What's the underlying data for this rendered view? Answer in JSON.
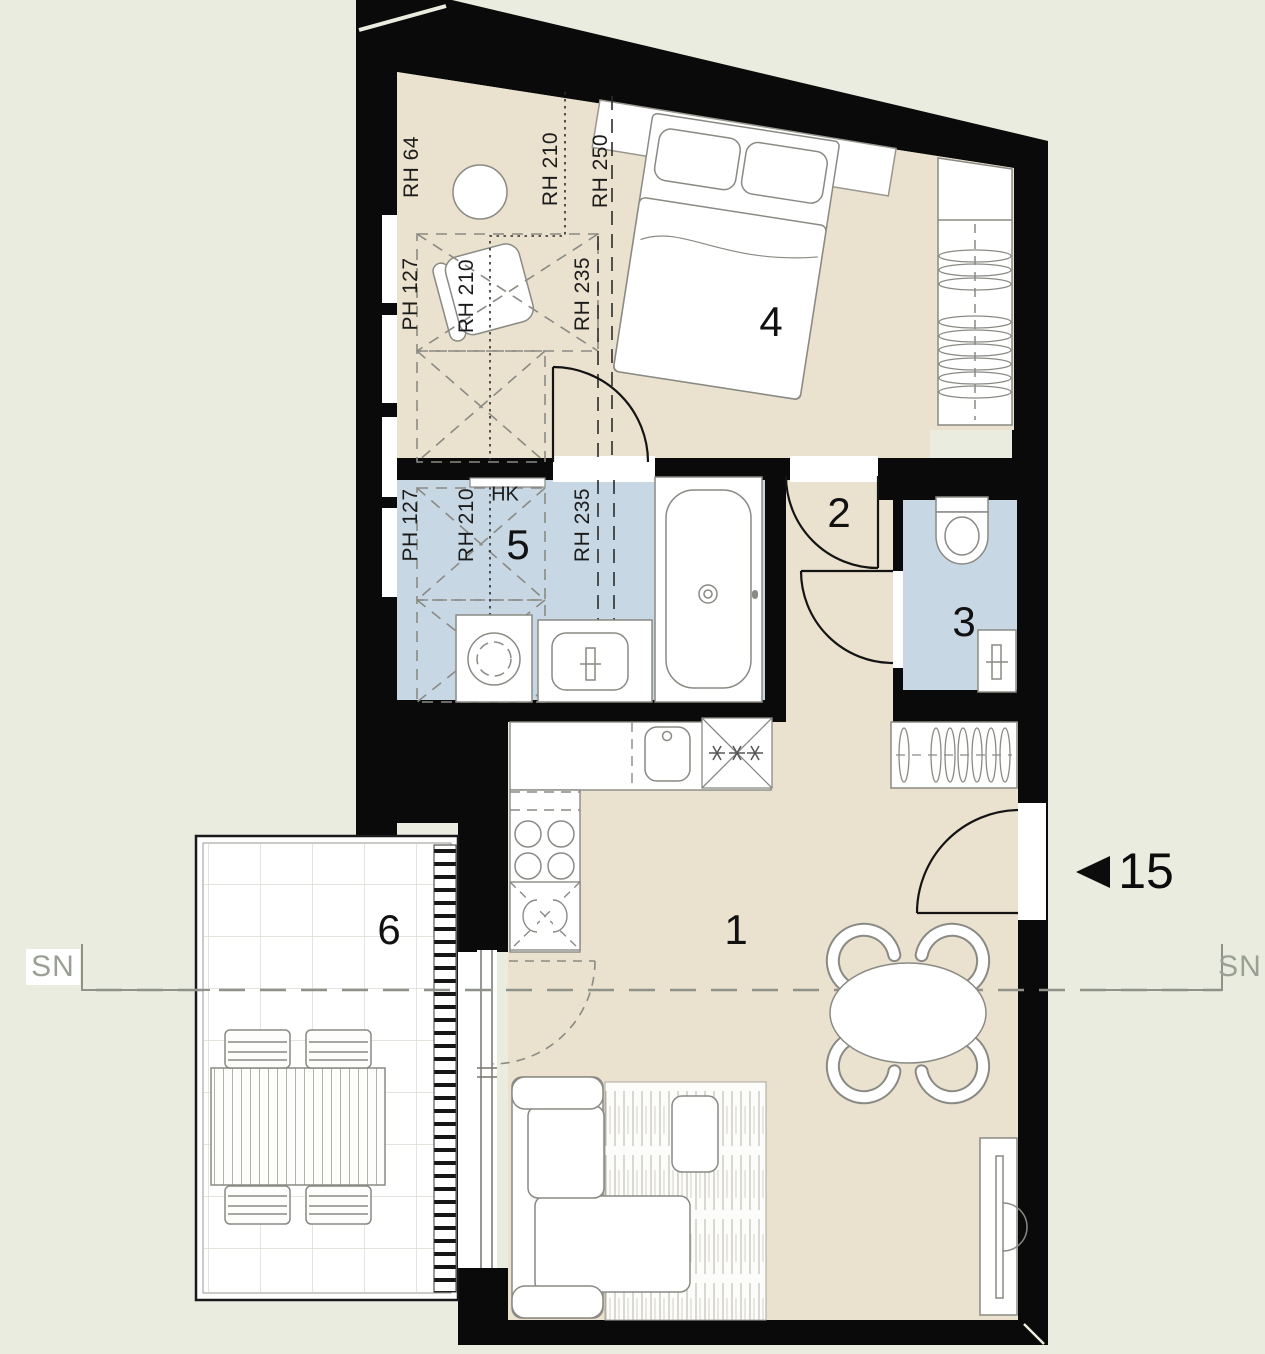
{
  "plan": {
    "unit": {
      "number": "15"
    },
    "section_marker": "SN",
    "room_numbers": {
      "living": "1",
      "hall": "2",
      "wc": "3",
      "bedroom": "4",
      "bath": "5",
      "balcony": "6"
    },
    "height_annotations": {
      "rh64": "RH 64",
      "rh210": "RH 210",
      "rh250": "RH 250",
      "ph127": "PH 127",
      "rh235": "RH 235",
      "hk": "HK"
    },
    "colors": {
      "background": "#e9ecdf",
      "floor_main": "#eae1ce",
      "floor_wet": "#c8d7e4",
      "wall": "#0a0a0a",
      "balcony_floor": "#ffffff",
      "annotation": "#1c1c1c",
      "section_line": "#8e9288"
    }
  }
}
